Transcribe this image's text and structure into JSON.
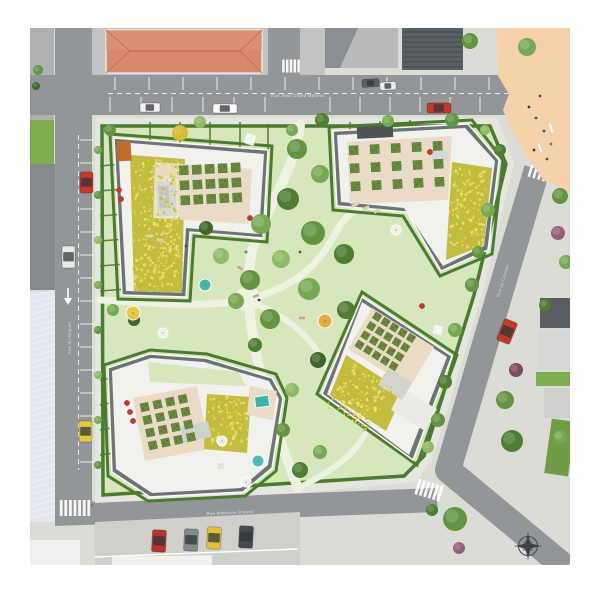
{
  "streets": {
    "north": {
      "name": "Rue Jean Girard Marieux"
    },
    "west": {
      "name": "Rue du Muguet"
    },
    "south": {
      "name": "Rue Ambroise Croizat"
    },
    "east": {
      "name": "Rue du Champy"
    }
  },
  "palette": {
    "road": "#939698",
    "sidewalk": "#dcdcd7",
    "block_sidewalk": "#e6e6e1",
    "lawn": "#d7e6bb",
    "path": "#eef2e1",
    "hedge": "#4b7a30",
    "plaza": "#f6d2ab",
    "red_roof": "#d8886e",
    "red_roof_ridge": "#c1705a",
    "meadow": "#c2bc40",
    "meadow_speckles": [
      "#e9de58",
      "#b7bd3e",
      "#f0e47a"
    ],
    "terrace": "#eadbc6",
    "planter_green": "#5f8f3e",
    "planter_red": "#c13a2c",
    "building_light": "#f1f1ed",
    "building_dark": "#6e7375",
    "parapet": "#fdfdfb",
    "hall_roof": "#e3e7f0",
    "marking_white": "#ffffff",
    "compass": "#3c4146"
  },
  "trees": [
    [
      297,
      149,
      10,
      "#639441"
    ],
    [
      320,
      174,
      9,
      "#78a854"
    ],
    [
      288,
      199,
      11,
      "#4e7d33"
    ],
    [
      261,
      224,
      10,
      "#78a854"
    ],
    [
      313,
      233,
      12,
      "#639441"
    ],
    [
      344,
      254,
      10,
      "#4e7d33"
    ],
    [
      281,
      259,
      9,
      "#8fba68"
    ],
    [
      250,
      280,
      10,
      "#639441"
    ],
    [
      309,
      289,
      11,
      "#78a854"
    ],
    [
      346,
      310,
      9,
      "#4e7d33"
    ],
    [
      270,
      319,
      10,
      "#639441"
    ],
    [
      236,
      301,
      8,
      "#78a854"
    ],
    [
      221,
      256,
      8,
      "#8fba68"
    ],
    [
      180,
      133,
      8,
      "#d9b832"
    ],
    [
      292,
      390,
      7,
      "#8fba68"
    ],
    [
      318,
      360,
      8,
      "#3e672a"
    ],
    [
      255,
      345,
      7,
      "#4e7d33"
    ],
    [
      292,
      130,
      6,
      "#78a854"
    ],
    [
      206,
      228,
      7,
      "#3e672a"
    ],
    [
      110,
      130,
      6,
      "#639441"
    ],
    [
      200,
      122,
      6,
      "#8fba68"
    ],
    [
      322,
      120,
      7,
      "#4e7d33"
    ],
    [
      388,
      121,
      6,
      "#78a854"
    ],
    [
      452,
      120,
      7,
      "#639441"
    ],
    [
      485,
      130,
      5,
      "#8fba68"
    ],
    [
      500,
      150,
      6,
      "#4e7d33"
    ],
    [
      488,
      210,
      7,
      "#78a854"
    ],
    [
      478,
      252,
      6,
      "#639441"
    ],
    [
      472,
      285,
      7,
      "#639441"
    ],
    [
      455,
      330,
      7,
      "#78a854"
    ],
    [
      445,
      382,
      7,
      "#4e7d33"
    ],
    [
      438,
      420,
      7,
      "#639441"
    ],
    [
      428,
      447,
      6,
      "#8fba68"
    ],
    [
      300,
      470,
      8,
      "#4e7d33"
    ],
    [
      320,
      452,
      7,
      "#78a854"
    ],
    [
      283,
      430,
      7,
      "#639441"
    ],
    [
      113,
      310,
      6,
      "#78a854"
    ],
    [
      134,
      320,
      6,
      "#3e672a"
    ],
    [
      98,
      150,
      4,
      "#78a854"
    ],
    [
      98,
      195,
      4,
      "#639441"
    ],
    [
      98,
      240,
      4,
      "#8fba68"
    ],
    [
      98,
      285,
      4,
      "#78a854"
    ],
    [
      98,
      330,
      4,
      "#639441"
    ],
    [
      98,
      375,
      4,
      "#8fba68"
    ],
    [
      98,
      420,
      4,
      "#78a854"
    ],
    [
      98,
      465,
      4,
      "#639441"
    ],
    [
      470,
      41,
      8,
      "#639441"
    ],
    [
      527,
      47,
      9,
      "#78a854"
    ],
    [
      560,
      196,
      8,
      "#639441"
    ],
    [
      558,
      233,
      7,
      "#96607a"
    ],
    [
      566,
      262,
      7,
      "#78a854"
    ],
    [
      545,
      305,
      6,
      "#4e7d33"
    ],
    [
      516,
      370,
      7,
      "#7c4a5e"
    ],
    [
      505,
      400,
      9,
      "#639441"
    ],
    [
      512,
      441,
      11,
      "#4e7d33"
    ],
    [
      560,
      437,
      7,
      "#78a854"
    ],
    [
      455,
      519,
      12,
      "#639441"
    ],
    [
      459,
      548,
      6,
      "#96607a"
    ],
    [
      432,
      510,
      6,
      "#4e7d33"
    ],
    [
      38,
      70,
      5,
      "#639441"
    ],
    [
      36,
      86,
      4,
      "#3e672a"
    ]
  ],
  "cars": [
    [
      140,
      103,
      20,
      9,
      0,
      "#f2f2f0"
    ],
    [
      213,
      104,
      24,
      9,
      0,
      "#fafafa"
    ],
    [
      362,
      79,
      17,
      8,
      -3,
      "#5a5f63"
    ],
    [
      380,
      82,
      16,
      8,
      -3,
      "#eeeeec"
    ],
    [
      427,
      103,
      24,
      10,
      0,
      "#c0392b"
    ],
    [
      80,
      172,
      13,
      21,
      0,
      "#c8362c"
    ],
    [
      62,
      246,
      13,
      22,
      0,
      "#e9e9e7"
    ],
    [
      79,
      421,
      13,
      21,
      0,
      "#e4c83f"
    ],
    [
      152,
      530,
      14,
      22,
      3,
      "#b6352b"
    ],
    [
      184,
      529,
      14,
      22,
      3,
      "#85888c"
    ],
    [
      207,
      527,
      14,
      22,
      3,
      "#e2c23a"
    ],
    [
      239,
      526,
      14,
      22,
      3,
      "#474b4f"
    ],
    [
      500,
      320,
      14,
      23,
      22,
      "#c0392b"
    ]
  ],
  "planter_grids": [
    {
      "tx": 179,
      "ty": 166,
      "rot": -3,
      "cols": 5,
      "rows": 3,
      "cell": 9,
      "gx": 4,
      "gy": 6
    },
    {
      "tx": 349,
      "ty": 146,
      "rot": -3,
      "cols": 5,
      "rows": 3,
      "cell": 9,
      "gx": 12,
      "gy": 9
    },
    {
      "tx": 140,
      "ty": 404,
      "rot": -12,
      "cols": 4,
      "rows": 4,
      "cell": 8,
      "gx": 5,
      "gy": 5
    },
    {
      "tx": 376,
      "ty": 312,
      "rot": 32,
      "cols": 5,
      "rows": 4,
      "cell": 7,
      "gx": 3,
      "gy": 4
    }
  ],
  "meadow_patches": [
    {
      "x": 134,
      "y": 160,
      "w": 46,
      "h": 130,
      "rot": 0
    },
    {
      "x": 452,
      "y": 168,
      "w": 36,
      "h": 80,
      "rot": 3
    },
    {
      "x": 208,
      "y": 398,
      "w": 38,
      "h": 50,
      "rot": -4
    },
    {
      "x": 352,
      "y": 362,
      "w": 50,
      "h": 52,
      "rot": 32
    }
  ],
  "umbrellas": [
    {
      "x": 250,
      "y": 139,
      "s": 11,
      "rot": 20,
      "c": "#f7f7f3",
      "type": "sq"
    },
    {
      "x": 205,
      "y": 285,
      "r": 6,
      "c": "#3fb5ad",
      "type": "c"
    },
    {
      "x": 133,
      "y": 313,
      "r": 7,
      "c": "#e8c93e",
      "type": "c"
    },
    {
      "x": 163,
      "y": 333,
      "r": 5,
      "c": "#f2f1ec",
      "type": "c"
    },
    {
      "x": 258,
      "y": 461,
      "r": 6,
      "c": "#47bcb4",
      "type": "c"
    },
    {
      "x": 246,
      "y": 482,
      "r": 5,
      "c": "#f2f1ec",
      "type": "c"
    },
    {
      "x": 438,
      "y": 330,
      "s": 10,
      "rot": 12,
      "c": "#f7f7f3",
      "type": "sq"
    },
    {
      "x": 325,
      "y": 321,
      "r": 7,
      "c": "#e2a93a",
      "type": "c"
    },
    {
      "x": 396,
      "y": 230,
      "r": 5,
      "c": "#f2f1ec",
      "type": "c"
    },
    {
      "x": 222,
      "y": 441,
      "r": 5,
      "c": "#f2f1ec",
      "type": "c"
    }
  ],
  "furniture": [
    [
      256,
      296,
      6,
      2.5,
      -20,
      "#b9a98e"
    ],
    [
      240,
      268,
      6,
      2.5,
      30,
      "#b9a98e"
    ],
    [
      302,
      318,
      6,
      2.5,
      0,
      "#b9a98e"
    ],
    [
      355,
      205,
      7,
      3,
      -25,
      "#ddd0b4"
    ],
    [
      366,
      208,
      7,
      3,
      -25,
      "#ddd0b4"
    ],
    [
      377,
      211,
      7,
      3,
      -25,
      "#ddd0b4"
    ],
    [
      540,
      148,
      9,
      2,
      75,
      "#ffffff"
    ],
    [
      551,
      128,
      9,
      2,
      75,
      "#ffffff"
    ],
    [
      150,
      236,
      7,
      3,
      0,
      "#ddd0b4"
    ],
    [
      160,
      240,
      7,
      3,
      10,
      "#ddd0b4"
    ],
    [
      221,
      466,
      6,
      6,
      0,
      "#e8e2d4"
    ]
  ],
  "red_objects": [
    [
      250,
      218
    ],
    [
      119,
      190
    ],
    [
      121,
      199
    ],
    [
      127,
      403
    ],
    [
      130,
      412
    ],
    [
      133,
      421
    ],
    [
      430,
      152
    ],
    [
      422,
      306
    ]
  ],
  "people": [
    [
      529,
      107
    ],
    [
      536,
      118
    ],
    [
      544,
      131
    ],
    [
      551,
      144
    ],
    [
      534,
      150
    ],
    [
      547,
      159
    ],
    [
      540,
      96
    ],
    [
      246,
      252
    ],
    [
      259,
      300
    ],
    [
      300,
      252
    ],
    [
      186,
      246
    ],
    [
      92,
      505
    ]
  ],
  "hedge_dividers": [
    [
      100,
      166,
      122,
      164
    ],
    [
      100,
      191,
      123,
      189
    ],
    [
      100,
      216,
      124,
      214
    ],
    [
      100,
      241,
      125,
      239
    ],
    [
      100,
      266,
      126,
      264
    ],
    [
      100,
      291,
      127,
      289
    ],
    [
      150,
      122,
      150,
      146
    ],
    [
      180,
      122,
      180,
      148
    ],
    [
      210,
      122,
      210,
      150
    ],
    [
      240,
      122,
      240,
      151
    ],
    [
      268,
      124,
      268,
      152
    ],
    [
      350,
      122,
      350,
      132
    ],
    [
      380,
      121,
      380,
      130
    ],
    [
      410,
      120,
      410,
      128
    ],
    [
      100,
      380,
      112,
      378
    ],
    [
      100,
      405,
      110,
      403
    ],
    [
      100,
      430,
      111,
      428
    ],
    [
      100,
      455,
      113,
      453
    ],
    [
      165,
      364,
      165,
      380
    ],
    [
      190,
      366,
      190,
      382
    ],
    [
      215,
      370,
      215,
      386
    ]
  ],
  "parking_lines": [
    {
      "dir": "v",
      "from": 115,
      "to": 490,
      "step": 34,
      "a": 77,
      "b": 90
    },
    {
      "dir": "v",
      "from": 110,
      "to": 265,
      "step": 31,
      "a": 97,
      "b": 112
    },
    {
      "dir": "v",
      "from": 330,
      "to": 510,
      "step": 30,
      "a": 97,
      "b": 112
    },
    {
      "dir": "h",
      "from": 140,
      "to": 462,
      "step": 23,
      "a": 80,
      "b": 94
    },
    {
      "dir": "v",
      "from": 108,
      "to": 294,
      "step": 18.5,
      "a": 523,
      "b": 556
    }
  ],
  "dash_lines": [
    {
      "x1": 108,
      "y1": 93.5,
      "x2": 515,
      "y2": 93.5
    },
    {
      "x1": 78.5,
      "y1": 135,
      "x2": 78.5,
      "y2": 470
    }
  ],
  "crosswalks": [
    {
      "tx": 526,
      "ty": 93,
      "rot": 0,
      "n": 6,
      "bw": 13,
      "bh": 2.6,
      "sx": 0,
      "sy": 6.2
    },
    {
      "tx": 291,
      "ty": 66,
      "rot": 0,
      "n": 5,
      "bw": 2.5,
      "bh": 13,
      "sx": 3.8,
      "sy": 0
    },
    {
      "tx": 75,
      "ty": 508,
      "rot": 0,
      "n": 7,
      "bw": 2.8,
      "bh": 16,
      "sx": 4.6,
      "sy": 0
    },
    {
      "tx": 429,
      "ty": 490,
      "rot": -73,
      "n": 6,
      "bw": 16,
      "bh": 2.8,
      "sx": 0,
      "sy": 4.6
    },
    {
      "tx": 540,
      "ty": 174,
      "rot": -73,
      "n": 5,
      "bw": 12,
      "bh": 2.5,
      "sx": 0,
      "sy": 5
    }
  ]
}
